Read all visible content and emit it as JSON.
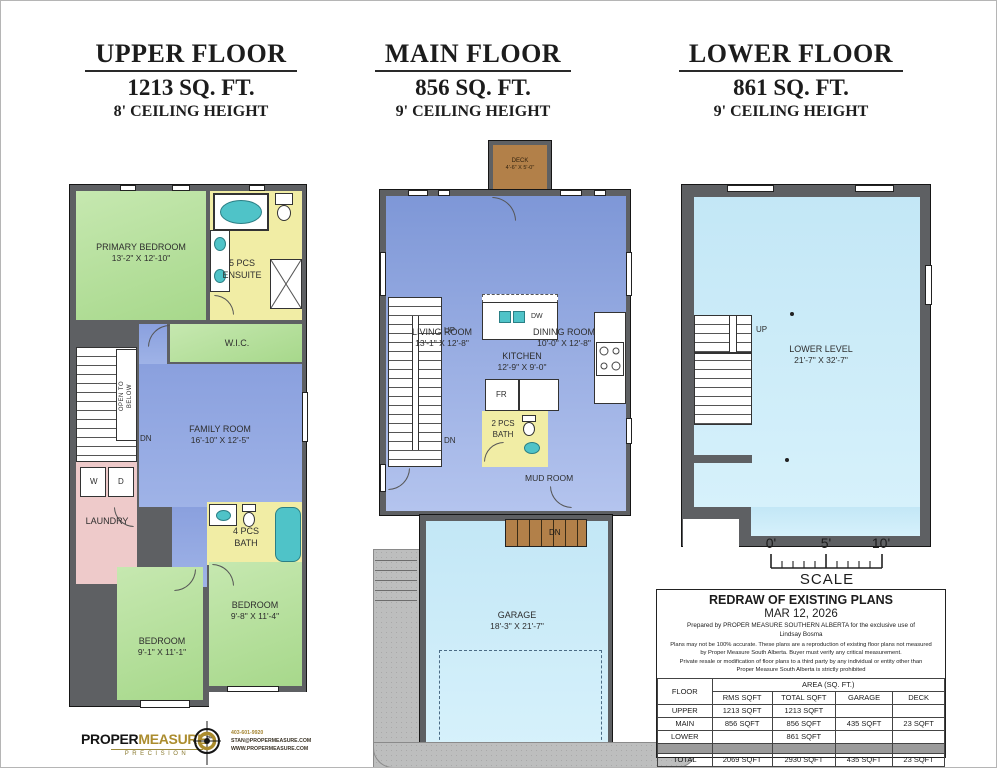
{
  "colors": {
    "wall": "#5e6063",
    "green": "#b5e09c",
    "yellow": "#f1eda5",
    "blue": "#8aa0de",
    "light_blue": "#c9ebf8",
    "pink": "#eecaca",
    "brown": "#b28049",
    "teal_fixture": "#4fc3c8",
    "driveway_gray": "#bdbebe",
    "brand_gold": "#ab8c2e"
  },
  "floors": {
    "upper": {
      "title": "UPPER FLOOR",
      "area": "1213 SQ. FT.",
      "ceiling": "8' CEILING HEIGHT",
      "primary_bedroom": {
        "name": "PRIMARY BEDROOM",
        "dims": "13'-2\" X 12'-10\""
      },
      "ensuite": {
        "line1": "5 PCS",
        "line2": "ENSUITE"
      },
      "wic": {
        "name": "W.I.C."
      },
      "family_room": {
        "name": "FAMILY ROOM",
        "dims": "16'-10\" X 12'-5\""
      },
      "laundry": {
        "name": "LAUNDRY"
      },
      "washer": "W",
      "dryer": "D",
      "bath": {
        "line1": "4 PCS",
        "line2": "BATH"
      },
      "bedroom_left": {
        "name": "BEDROOM",
        "dims": "9'-1\" X 11'-1\""
      },
      "bedroom_right": {
        "name": "BEDROOM",
        "dims": "9'-8\" X 11'-4\""
      },
      "open_to_below_1": "OPEN TO",
      "open_to_below_2": "BELOW",
      "dn": "DN"
    },
    "main": {
      "title": "MAIN FLOOR",
      "area": "856 SQ. FT.",
      "ceiling": "9' CEILING HEIGHT",
      "deck": {
        "name": "DECK",
        "dims": "4'-6\" X 5'-0\""
      },
      "living_room": {
        "name": "LIVING ROOM",
        "dims": "13'-1\" X 12'-8\""
      },
      "dining_room": {
        "name": "DINING ROOM",
        "dims": "10'-0\" X 12'-8\""
      },
      "kitchen": {
        "name": "KITCHEN",
        "dims": "12'-9\" X 9'-0\""
      },
      "dw": "DW",
      "fr": "FR",
      "bath": {
        "line1": "2 PCS",
        "line2": "BATH"
      },
      "mud_room": "MUD ROOM",
      "garage": {
        "name": "GARAGE",
        "dims": "18'-3\" X 21'-7\""
      },
      "up": "UP",
      "dn": "DN",
      "garage_dn": "DN"
    },
    "lower": {
      "title": "LOWER FLOOR",
      "area": "861 SQ. FT.",
      "ceiling": "9' CEILING HEIGHT",
      "lower_level": {
        "name": "LOWER LEVEL",
        "dims": "21'-7\" X 32'-7\""
      },
      "up": "UP"
    }
  },
  "scale": {
    "tick0": "0'",
    "tick5": "5'",
    "tick10": "10'",
    "label": "SCALE"
  },
  "info_table": {
    "title": "REDRAW OF EXISTING PLANS",
    "date": "MAR 12, 2026",
    "prepared_line1": "Prepared by PROPER MEASURE SOUTHERN ALBERTA for the exclusive use of",
    "prepared_line2": "Lindsay Bosma",
    "disclaimer_line1": "Plans may not be 100% accurate. These plans are a reproduction of existing floor plans not measured",
    "disclaimer_line2": "by  Proper Measure South Alberta.  Buyer must verify any critical measurement.",
    "disclaimer_line3": "Private resale  or modification of floor plans to a third party by any individual or entity other than",
    "disclaimer_line4": "Proper Measure South Alberta is strictly prohibited",
    "header_floor": "FLOOR",
    "header_area": "AREA (SQ. FT.)",
    "columns": [
      "RMS SQFT",
      "TOTAL SQFT",
      "GARAGE",
      "DECK"
    ],
    "rows": [
      {
        "floor": "UPPER",
        "rms": "1213 SQFT",
        "total": "1213 SQFT",
        "garage": "",
        "deck": ""
      },
      {
        "floor": "MAIN",
        "rms": "856 SQFT",
        "total": "856 SQFT",
        "garage": "435 SQFT",
        "deck": "23 SQFT"
      },
      {
        "floor": "LOWER",
        "rms": "",
        "total": "861 SQFT",
        "garage": "",
        "deck": ""
      },
      {
        "floor": "",
        "rms": "",
        "total": "",
        "garage": "",
        "deck": ""
      },
      {
        "floor": "TOTAL",
        "rms": "2069 SQFT",
        "total": "2930 SQFT",
        "garage": "435 SQFT",
        "deck": "23 SQFT"
      }
    ]
  },
  "logo": {
    "brand_black": "PROPER",
    "brand_gold": "MEASURE",
    "tm": "TM",
    "tagline": "PRECISION",
    "phone": "403-601-9920",
    "email": "STAN@PROPERMEASURE.COM",
    "website": "WWW.PROPERMEASURE.COM"
  }
}
